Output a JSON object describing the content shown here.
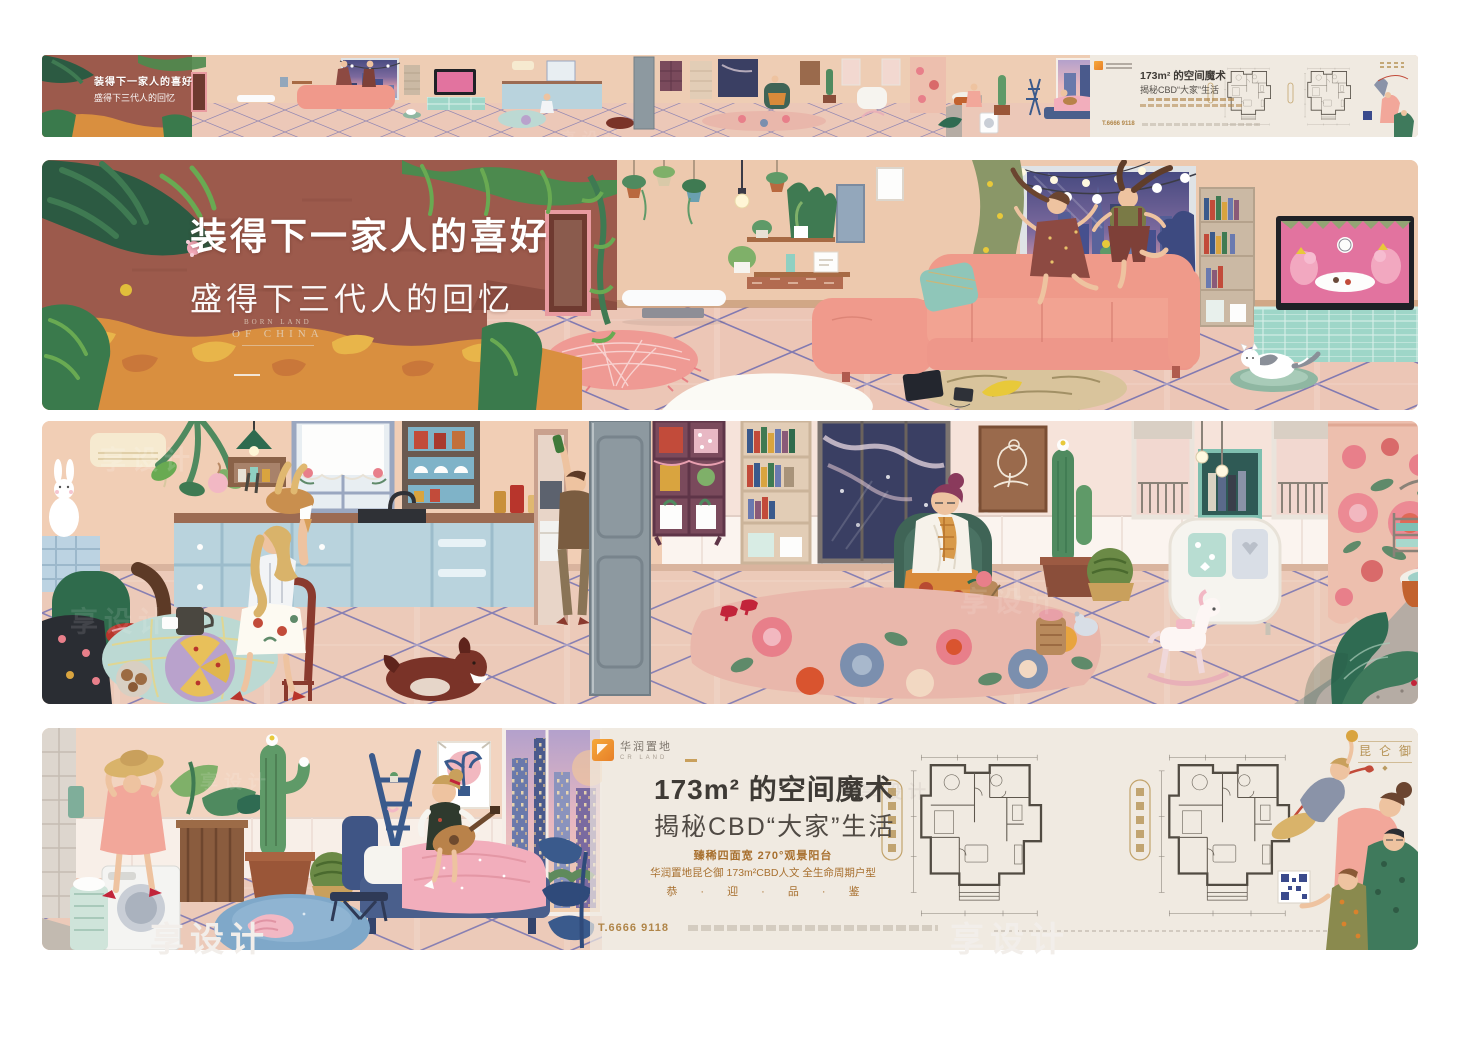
{
  "page": {
    "background": "#ffffff",
    "watermark": "享设计"
  },
  "slogan": {
    "line1": "装得下一家人的喜好",
    "line2": "盛得下三代人的回忆",
    "tagline_line1": "BORN LAND",
    "tagline_line2": "OF CHINA"
  },
  "ad_panel": {
    "logo_name": "华润置地",
    "logo_sub": "CR LAND",
    "headline": "173m² 的空间魔术",
    "subheadline": "揭秘CBD“大家”生活",
    "feature_line1": "臻稀四面宽 270°观景阳台",
    "feature_line2": "华润置地昆仑御 173m²CBD人文 全生命周期户型",
    "ceremony_line": "恭 · 迎 · 品 · 鉴",
    "emblem": "昆仑御",
    "emblem_ornament": "◆",
    "phone": "T.6666 9118"
  },
  "icons": {
    "qr_code": "qr-code",
    "brand_mark": "cr-land-mark"
  },
  "palette": {
    "brick_wall": "#9c5a4c",
    "interior_wall": "#edc9ae",
    "floor": "#ecc8b8",
    "floor_line_blue": "#4e55ae",
    "sofa_pink": "#f0998b",
    "teal_tile": "#9ed6c8",
    "panel_beige": "#f0eae1",
    "headline_ink": "#3e3a35",
    "feature_brown": "#a8702f",
    "gold": "#b59254",
    "navy": "#3c5587",
    "plan_ink": "#55504a"
  }
}
